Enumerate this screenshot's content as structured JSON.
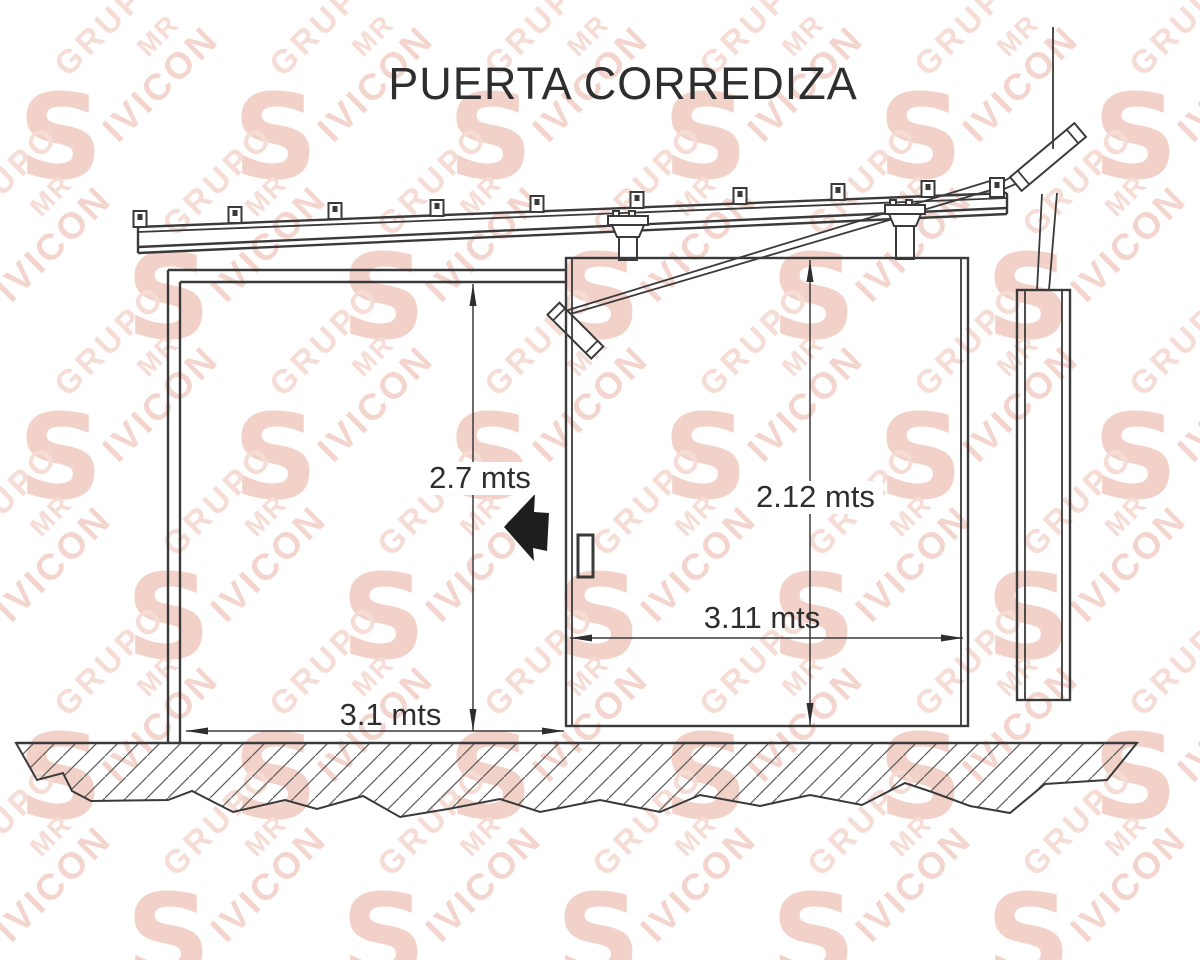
{
  "title": "PUERTA CORREDIZA",
  "watermark": {
    "grupo": "GRUPO",
    "mr": "MR",
    "ivicon": "IVICON",
    "logo_letter": "S",
    "color": "#f3d5ce"
  },
  "dimensions": {
    "opening_height": {
      "value": "2.7 mts",
      "orientation": "vertical"
    },
    "door_height": {
      "value": "2.12 mts",
      "orientation": "vertical"
    },
    "door_width": {
      "value": "3.11 mts",
      "orientation": "horizontal"
    },
    "opening_width": {
      "value": "3.1 mts",
      "orientation": "horizontal"
    }
  },
  "colors": {
    "line": "#3a3a3a",
    "direction_arrow": "#1e1e1e",
    "watermark": "#f3d5ce",
    "background": "#ffffff"
  }
}
